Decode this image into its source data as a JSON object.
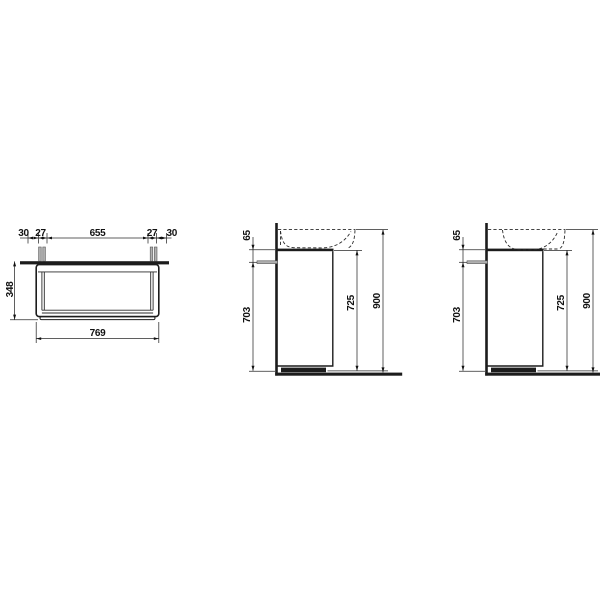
{
  "drawing_title": "vanity-unit-dimension-drawing",
  "front": {
    "chain": [
      "30",
      "27",
      "655",
      "27",
      "30"
    ],
    "height": "348",
    "width": "769"
  },
  "side_a": {
    "bracket_offset": "65",
    "body_height": "703",
    "cabinet_top_height": "725",
    "overall_height": "900"
  },
  "side_b": {
    "bracket_offset": "65",
    "body_height": "703",
    "cabinet_top_height": "725",
    "overall_height": "900"
  },
  "colors": {
    "line": "#1c1c1c",
    "thin_line": "#2a2a2a",
    "bracket_gray": "#b0b0b0",
    "background": "#ffffff"
  }
}
